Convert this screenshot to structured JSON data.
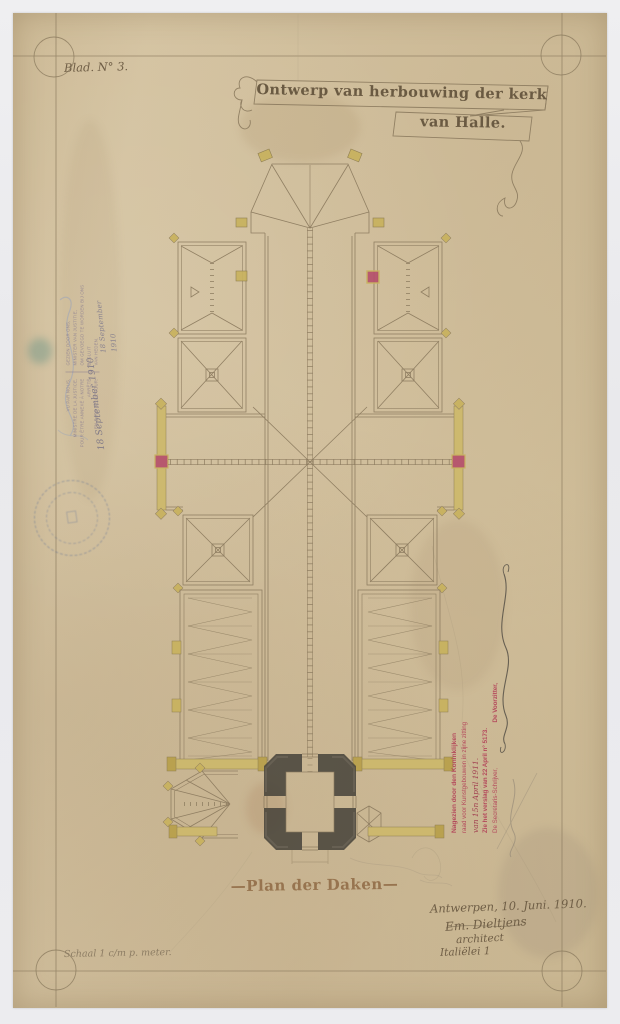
{
  "sheet": {
    "label": "Blad. N° 3."
  },
  "title": {
    "line1": "Ontwerp van herbouwing der kerk",
    "line2": "van Halle."
  },
  "caption": "—Plan der Daken—",
  "scale_note": "Schaal 1 c/m p. meter.",
  "signature_block": {
    "place_date": "Antwerpen, 10. Juni. 1910.",
    "name": "Em. Dieltjens",
    "role": "architect",
    "address": "Italiëlei 1"
  },
  "approval_stamp": {
    "line1": "Nagezien door den Koninklijken",
    "line2": "raad voor Kunstgebouwen in zijne zitting",
    "line3_handwritten": "van 15n April 1911.",
    "line4": "Zie het verslag van 22 April n° 5173.",
    "line5_left": "De Secretaris-Schrijver,",
    "line5_right": "De Voorzitter,"
  },
  "ministry_stamp": {
    "fr1": "VU PAR NOUS,",
    "fr2": "MINISTRE DE LA JUSTICE,",
    "fr3": "POUR ÊTRE ANNEXÉ À NOTRE ARRÊTÉ",
    "fr4": "EN DATE DE CE JOUR.",
    "nl1": "GEZIEN DOOR ONS,",
    "nl2": "MINISTER VAN JUSTITIE,",
    "nl3": "OM GEVOEGD TE WORDEN BIJ ONS BESLUIT",
    "nl4": "VAN HEDEN.",
    "handwritten_date": "18 September 1910",
    "handwritten_date2": "18 September 1910"
  },
  "colors": {
    "paper": "#d3c19e",
    "ink_line": "#8b7a5e",
    "ochre_accent": "#c8b25e",
    "red_accent": "#b5506b",
    "stamp_red": "#b23c55",
    "stamp_blue": "#5a6c96",
    "pier_dark": "#45423a"
  }
}
